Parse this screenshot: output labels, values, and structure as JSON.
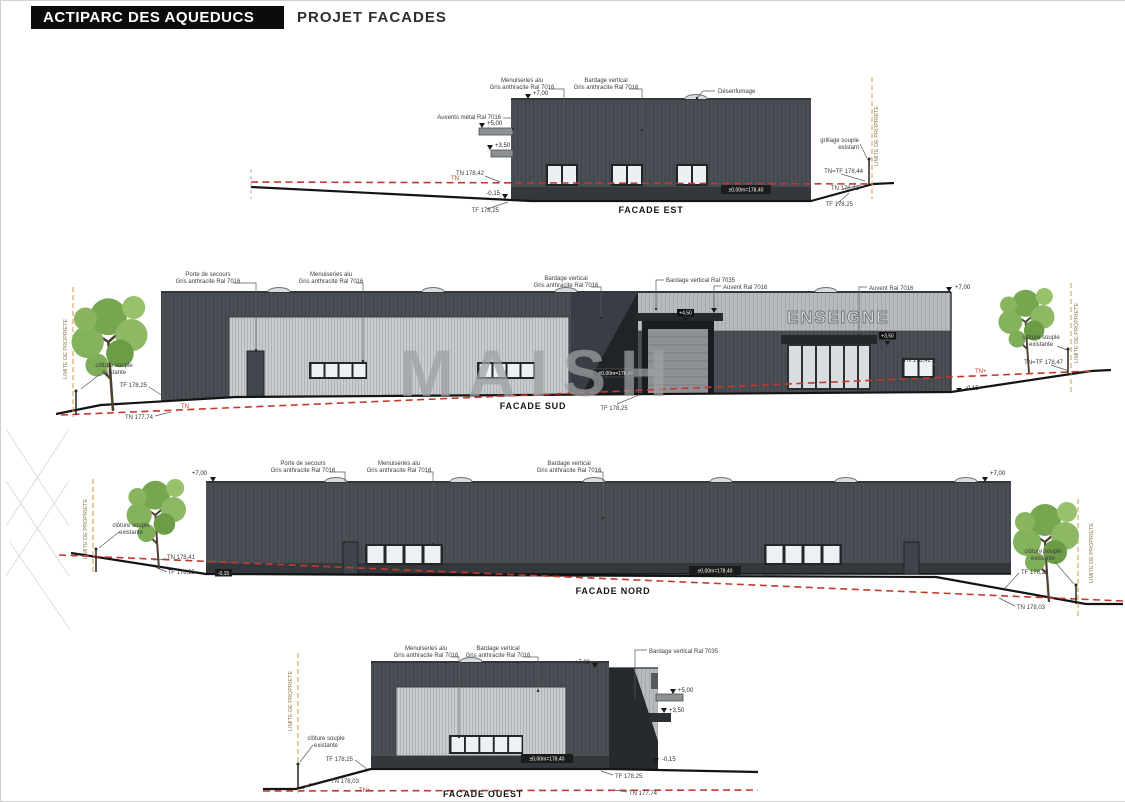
{
  "header": {
    "title": "ACTIPARC DES AQUEDUCS",
    "subtitle": "PROJET FACADES"
  },
  "watermark": "MAISH",
  "est": {
    "title": "FACADE EST",
    "ann_menuiseries_1": "Menuiseries alu",
    "ann_menuiseries_2": "Gris anthracite Ral 7016",
    "ann_bardage_1": "Bardage vertical",
    "ann_bardage_2": "Gris anthracite Ral 7016",
    "ann_auvents": "Auvents métal Ral 7016",
    "ann_desenfumage": "Désenfumage",
    "lvl_700": "+7,00",
    "lvl_500": "+5,00",
    "lvl_350": "+3,50",
    "lvl_m015": "-0,15",
    "tn_red": "TN",
    "tn_left": "TN 178,42",
    "tf_left": "TF 178,25",
    "tn_tf_right": "TN=TF 178,44",
    "tn_right": "TN 178,41",
    "tf_right": "TF 178,25",
    "grillage_1": "grillage souple",
    "grillage_2": "existant",
    "limite": "LIMITE DE PROPRIETE",
    "badge": "±0,00m=178,40"
  },
  "sud": {
    "title": "FACADE SUD",
    "ann_porte_1": "Porte de secours",
    "ann_porte_2": "Gris anthracite Ral 7016",
    "ann_menuiseries_1": "Menuiseries alu",
    "ann_menuiseries_2": "Gris anthracite Ral 7016",
    "ann_bardage_1": "Bardage vertical",
    "ann_bardage_2": "Gris anthracite Ral 7016",
    "ann_bardage7035": "Bardage vertical Ral 7035",
    "ann_auvent_mid": "Auvent Ral 7016",
    "ann_auvent_right": "Auvent Ral 7016",
    "enseigne": "ENSEIGNE",
    "lvl_700": "+7,00",
    "lvl_m015": "-0,15",
    "badge_door": "+4,50",
    "badge_entry": "+3,50",
    "badge": "±0,00m=178,40",
    "cloture_1": "clôture souple",
    "cloture_2": "existante",
    "cloture_r1": "clôture souple",
    "cloture_r2": "existante",
    "tf_left": "TF 178,25",
    "tn_left": "TN 177,74",
    "tn_red_left": "TN",
    "tn_red_right": "TN+",
    "tn_right": "TN 178,42",
    "tn_tf_right": "TN=TF 178,47",
    "tf_bottom": "TF 178,25",
    "limite_left": "LIMITE DE PROPRIETE",
    "limite_right": "LIMITE DE PROPRIETE"
  },
  "nord": {
    "title": "FACADE NORD",
    "ann_porte_1": "Porte de secours",
    "ann_porte_2": "Gris anthracite Ral 7016",
    "ann_menuiseries_1": "Menuiseries alu",
    "ann_menuiseries_2": "Gris anthracite Ral 7016",
    "ann_bardage_1": "Bardage vertical",
    "ann_bardage_2": "Gris anthracite Ral 7016",
    "lvl_700_l": "+7,00",
    "lvl_700_r": "+7,00",
    "badge": "±0,00m=178,40",
    "badge_m015": "-0,15",
    "cloture_1": "clôture souple",
    "cloture_2": "existante",
    "cloture_r1": "clôture souple",
    "cloture_r2": "existante",
    "tn_left": "TN 178,41",
    "tf_left": "TF 178,25",
    "tf_right": "TF 178,25",
    "tn_right": "TN 178,03",
    "limite_left": "LIMITE DE PROPRIETE",
    "limite_right": "LIMITE DE PROPRIETE"
  },
  "ouest": {
    "title": "FACADE OUEST",
    "ann_menuiseries_1": "Menuiseries alu",
    "ann_menuiseries_2": "Gris anthracite Ral 7016",
    "ann_bardage_1": "Bardage vertical",
    "ann_bardage_2": "Gris anthracite Ral 7016",
    "ann_bardage7035": "Bardage vertical Ral 7035",
    "lvl_700": "+7,00",
    "lvl_500": "+5,00",
    "lvl_350": "+3,50",
    "lvl_m015": "-0,15",
    "badge": "±0,00m=178,40",
    "cloture_1": "clôture souple",
    "cloture_2": "existante",
    "tf_left": "TF 178,25",
    "tn_left": "TN 178,03",
    "tf_right": "TF 178,25",
    "tn_right": "TN 177,74",
    "tn_red": "TN+",
    "limite": "LIMITE DE PROPRIETE"
  }
}
